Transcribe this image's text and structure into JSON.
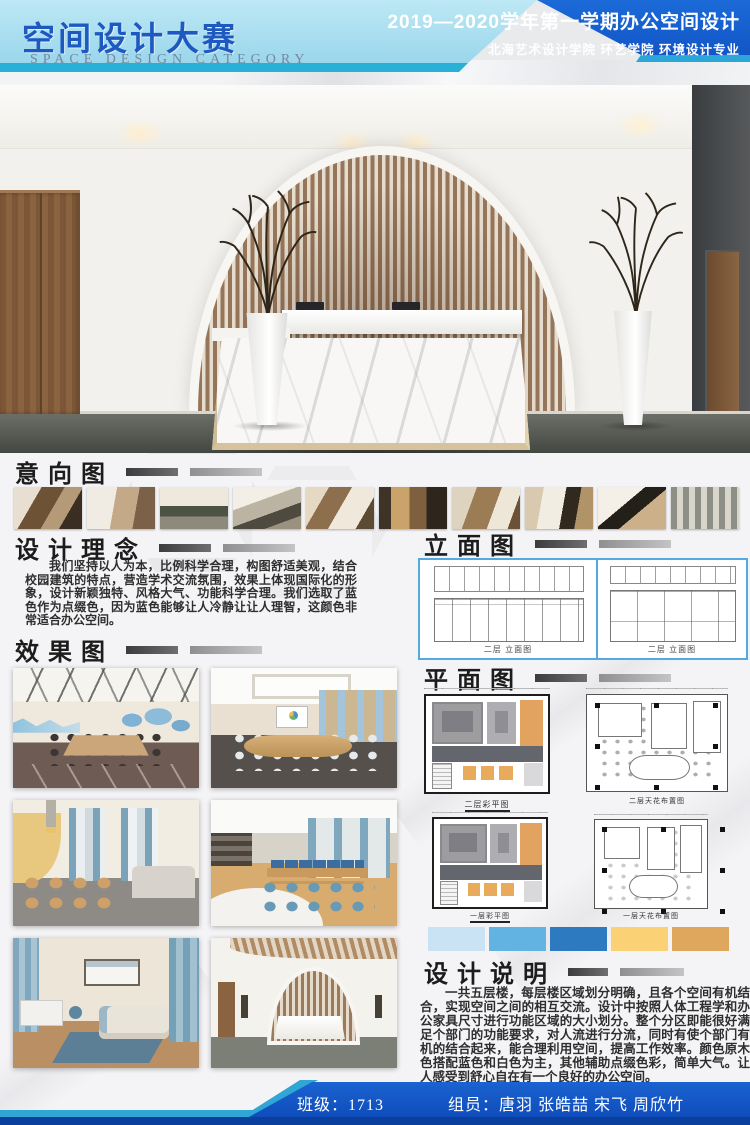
{
  "header": {
    "title": "空间设计大赛",
    "subtitle": "SPACE DESIGN CATEGORY",
    "term_title": "2019—2020学年第一学期办公空间设计",
    "school_line": "北海艺术设计学院  环艺学院  环境设计专业"
  },
  "sections": {
    "intent_title": "意向图",
    "concept_title": "设计理念",
    "concept_text": "我们坚持以人为本，比例科学合理，构图舒适美观，结合校园建筑的特点，营造学术交流氛围，效果上体现国际化的形象，设计新颖独特、风格大气、功能科学合理。我们选取了蓝色作为点缀色，因为蓝色能够让人冷静让让人理智，这颜色非常适合办公空间。",
    "effect_title": "效果图",
    "elevation_title": "立面图",
    "elevation_caption_left": "二层 立面图",
    "elevation_caption_right": "二层 立面图",
    "plan_title": "平面图",
    "plan_caption_1": "二层彩平图",
    "plan_caption_2": "二层天花布置图",
    "plan_caption_3": "一层彩平图",
    "plan_caption_4": "一层天花布置图",
    "description_title": "设计说明",
    "description_text": "一共五层楼，每层楼区域划分明确，且各个空间有机结合，实现空间之间的相互交流。设计中按照人体工程学和办公家具尺寸进行功能区域的大小划分。整个分区即能很好满足个部门的功能要求，对人流进行分流，同时有使个部门有机的结合起来，能合理利用空间，提高工作效率。颜色原木色搭配蓝色和白色为主，其他辅助点缀色彩，简单大气。让人感受到舒心自在有一个良好的办公空间。"
  },
  "palette": [
    "#c9e2f4",
    "#62b2e2",
    "#2d7ac0",
    "#fbd175",
    "#dfa65e"
  ],
  "colors": {
    "header_dark_blue": "#0f4cbb",
    "header_light_blue": "#a6dcee",
    "teal_accent": "#28b0d6",
    "title_blue": "#1d59c0",
    "footer_blue": "#1355c3",
    "footer_bottom_blue": "#0a3f9e"
  },
  "footer": {
    "class_label": "班级：1713",
    "members_label": "组员：唐羽  张皓喆  宋飞  周欣竹"
  },
  "images": {
    "hero": "reception-hall-render",
    "intent_thumbs": [
      "interior-photo-1",
      "interior-photo-2",
      "interior-photo-3",
      "interior-photo-4",
      "interior-photo-5",
      "interior-photo-6",
      "interior-photo-7",
      "interior-photo-8",
      "interior-photo-9",
      "interior-photo-10"
    ],
    "effect_renders": [
      "meeting-room-world-map",
      "large-conference-room",
      "leisure-lounge",
      "open-office-area",
      "manager-office",
      "reception-desk-area"
    ]
  }
}
